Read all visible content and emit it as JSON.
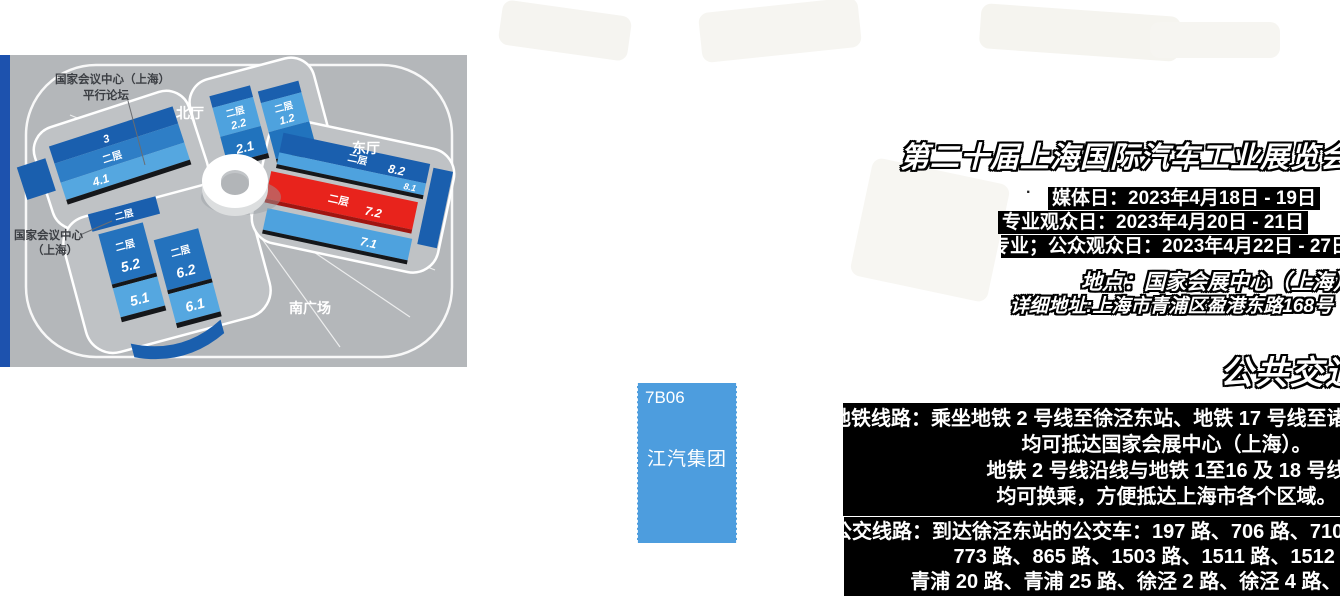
{
  "colors": {
    "stripe": "#1d52ae",
    "map_bg": "#b4b7ba",
    "booth_bg": "#4d9dde",
    "hall_dark": "#1a5fae",
    "hall_mid": "#2173bd",
    "hall_light": "#4ea2de",
    "hall_red": "#e8231c"
  },
  "map": {
    "forum_note_line1": "国家会议中心（上海）",
    "forum_note_line2": "平行论坛",
    "venue_note_line1": "国家会议中心",
    "venue_note_line2": "（上海）",
    "label_north_hall": "北厅",
    "label_east_hall": "东厅",
    "label_south_plaza": "南广场",
    "floor_label": "二层",
    "hall_numbers": {
      "h3": "3",
      "h41": "4.1",
      "h52": "5.2",
      "h51": "5.1",
      "h62": "6.2",
      "h61": "6.1",
      "h22": "2.2",
      "h21": "2.1",
      "h12": "1.2",
      "h11": "1.1",
      "h82": "8.2",
      "h81": "8.1",
      "h72": "7.2",
      "h71": "7.1"
    }
  },
  "booth": {
    "number": "7B06",
    "company": "江汽集团"
  },
  "exhibition": {
    "title": "第二十届上海国际汽车工业展览会",
    "bullet": "·",
    "schedule": [
      "媒体日：2023年4月18日 - 19日",
      "专业观众日：2023年4月20日 - 21日",
      "专业；公众观众日：2023年4月22日 - 27日"
    ],
    "venue": "地点：国家会展中心（上海）",
    "address": "详细地址:上海市青浦区盈港东路168号"
  },
  "transport": {
    "heading": "公共交通",
    "metro": [
      "地铁线路：乘坐地铁 2 号线至徐泾东站、地铁 17 号线至诸光路站",
      "均可抵达国家会展中心（上海）。",
      "地铁 2 号线沿线与地铁 1至16 及 18 号线",
      "均可换乘，方便抵达上海市各个区域。"
    ],
    "bus": [
      "公交线路：到达徐泾东站的公交车：197 路、706 路、710 路、",
      "773 路、865 路、1503 路、1511 路、1512 路、",
      "青浦 20 路、青浦 25 路、徐泾 2 路、徐泾 4 路、徐泾 5 路"
    ]
  }
}
